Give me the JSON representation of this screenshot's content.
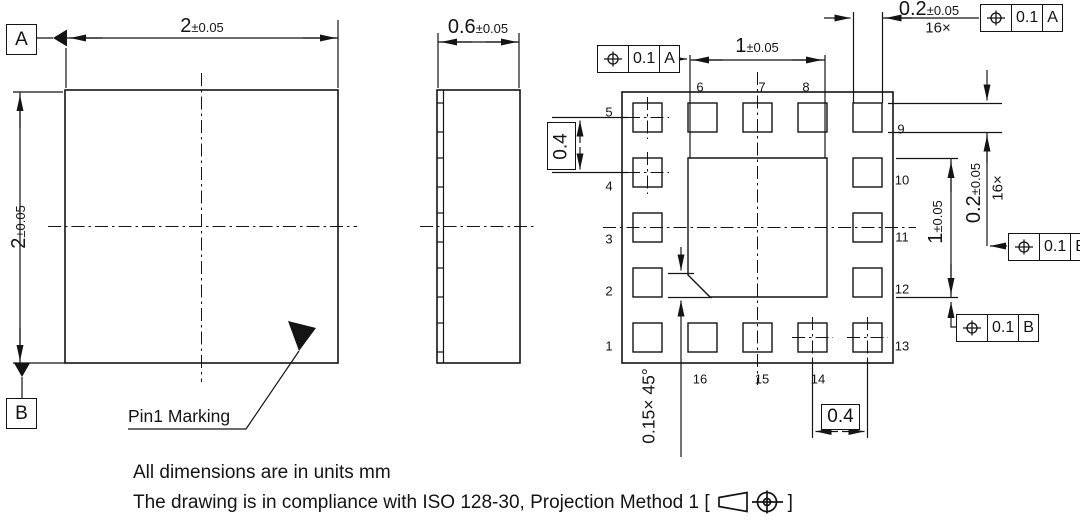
{
  "datums": {
    "a": "A",
    "b": "B"
  },
  "top_view": {
    "width_dim": {
      "value": "2",
      "tol": "±0.05"
    },
    "height_dim": {
      "value": "2",
      "tol": "±0.05"
    },
    "pin1_label": "Pin1 Marking"
  },
  "side_view": {
    "thickness_dim": {
      "value": "0.6",
      "tol": "±0.05"
    }
  },
  "bottom_view": {
    "pad_width_dim": {
      "value": "1",
      "tol": "±0.05"
    },
    "pad_height_dim": {
      "value": "1",
      "tol": "±0.05"
    },
    "pin_width_dim": {
      "value": "0.2",
      "tol": "±0.05",
      "count": "16×"
    },
    "pin_height_dim": {
      "value": "0.2",
      "tol": "±0.05",
      "count": "16×"
    },
    "pitch_left_dim": "0.4",
    "pitch_bottom_dim": "0.4",
    "chamfer_dim": "0.15× 45°",
    "fcf": {
      "top_left": {
        "tol": "0.1",
        "datum": "A"
      },
      "top_right": {
        "tol": "0.1",
        "datum": "A"
      },
      "right": {
        "tol": "0.1",
        "datum": "B"
      },
      "bottom_right": {
        "tol": "0.1",
        "datum": "B"
      }
    },
    "pins": {
      "left": [
        "5",
        "4",
        "3",
        "2",
        "1"
      ],
      "top": [
        "6",
        "7",
        "8"
      ],
      "right": [
        "9",
        "10",
        "11",
        "12",
        "13"
      ],
      "bottom": [
        "16",
        "15",
        "14"
      ]
    }
  },
  "notes": {
    "line1": "All dimensions are in units mm",
    "line2_prefix": "The drawing is in compliance with ISO 128-30, Projection Method 1 [",
    "line2_suffix": "]"
  }
}
